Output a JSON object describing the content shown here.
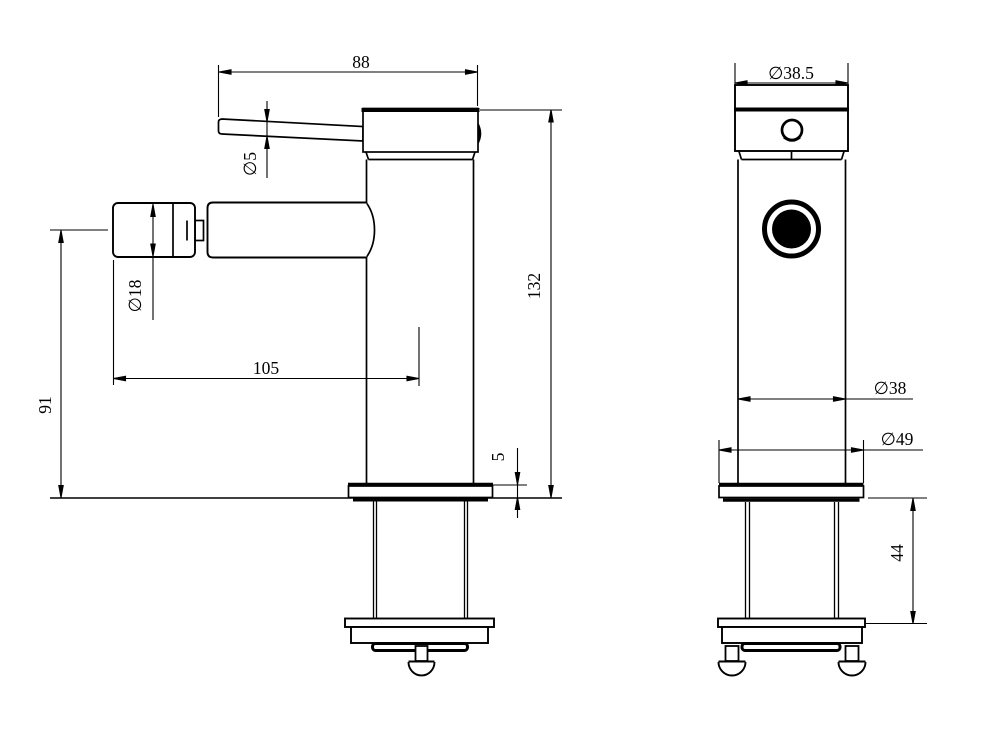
{
  "drawing": {
    "background": "#ffffff",
    "line_color": "#000000",
    "views": {
      "side": {
        "dims": {
          "lever_length": "88",
          "lever_dia": "∅5",
          "spout_dia": "∅18",
          "reach": "105",
          "spout_height": "91",
          "overall_height": "132",
          "plate_thickness": "5"
        }
      },
      "front": {
        "dims": {
          "cap_dia": "∅38.5",
          "body_dia": "∅38",
          "base_dia": "∅49",
          "shank_length": "44"
        }
      }
    }
  }
}
